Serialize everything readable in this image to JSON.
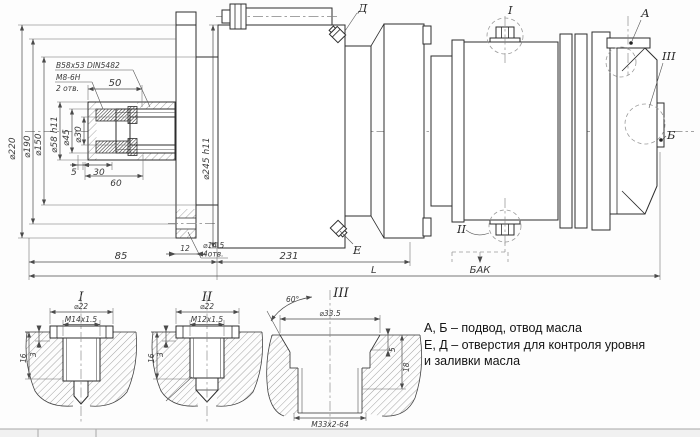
{
  "main": {
    "dims": {
      "d220": "⌀220",
      "d190": "⌀190",
      "d150": "⌀150",
      "d58": "⌀58 h11",
      "d45": "⌀45",
      "d30": "⌀30",
      "d245": "⌀245 h11",
      "n50": "50",
      "n5": "5",
      "n30": "30",
      "n60": "60",
      "n85": "85",
      "n12": "12",
      "n231": "231",
      "nL": "L",
      "hole_d": "⌀14.5",
      "hole_q": "4отв."
    },
    "notes": {
      "spline": "B58x53 DIN5482",
      "m8": "М8-6Н",
      "m8_qty": "2 отв.",
      "tank": "БАК"
    },
    "callouts": {
      "a": "А",
      "b": "Б",
      "d": "Д",
      "e": "Е",
      "i": "I",
      "ii": "II",
      "iii": "III"
    }
  },
  "details": {
    "i": {
      "title": "I",
      "d22": "⌀22",
      "thread": "М14х1.5",
      "n16": "16",
      "n3": "3"
    },
    "ii": {
      "title": "II",
      "d22": "⌀22",
      "thread": "М12х1.5",
      "n16": "16",
      "n3": "3"
    },
    "iii": {
      "title": "III",
      "angle": "60°",
      "d335": "⌀33.5",
      "n5": "5",
      "n18": "18",
      "thread": "М33х2-64"
    }
  },
  "legend": {
    "line1": "А, Б – подвод, отвод масла",
    "line2": "Е, Д – отверстия для контроля уровня",
    "line3": "и заливки масла"
  },
  "colors": {
    "line": "#2d2d2d",
    "dim": "#4a4a4a",
    "background": "#fdfdfd"
  }
}
